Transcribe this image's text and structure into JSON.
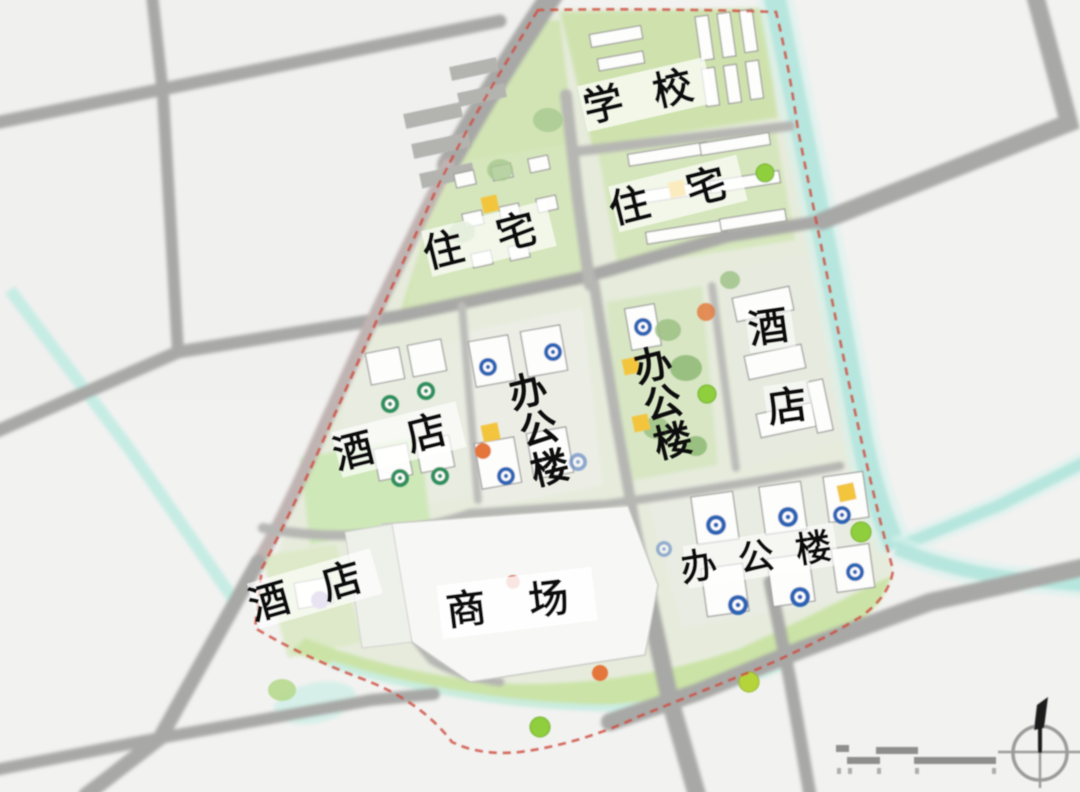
{
  "map": {
    "type": "urban-master-plan-site-map",
    "zones": [
      {
        "id": "school",
        "label": "学校",
        "display": "学 校"
      },
      {
        "id": "residential-west",
        "label": "住宅",
        "display": "住 宅"
      },
      {
        "id": "residential-east",
        "label": "住宅",
        "display": "住 宅"
      },
      {
        "id": "hotel-west",
        "label": "酒店",
        "display": "酒 店"
      },
      {
        "id": "office-central-west",
        "label": "办公楼",
        "chars": [
          "办",
          "公",
          "楼"
        ]
      },
      {
        "id": "office-central-east",
        "label": "办公楼",
        "chars": [
          "办",
          "公",
          "楼"
        ]
      },
      {
        "id": "hotel-east",
        "label": "酒店",
        "chars": [
          "酒",
          "店"
        ]
      },
      {
        "id": "hotel-southwest",
        "label": "酒店",
        "display": "酒 店"
      },
      {
        "id": "office-southeast",
        "label": "办公楼",
        "display": "办 公 楼"
      },
      {
        "id": "mall",
        "label": "商场",
        "display": "商 场"
      }
    ],
    "annotations": {
      "compass": "north-arrow",
      "scale_bar": "graphic-scale"
    },
    "palette": {
      "background": "#f1f1f0",
      "road": "#a8a8a6",
      "road_minor": "#b6b6b3",
      "boundary_road": "#c0b5b2",
      "water": "#b7e6de",
      "green_block": "#d6e6bc",
      "green_park": "#cbe3a6",
      "tree_bright": "#8fce3d",
      "building_fill": "#fdfdfb",
      "building_stroke": "#9a9a98",
      "boundary_red": "#cf4f42",
      "badge_blue": "#2a63b5",
      "badge_green": "#2f8f5b",
      "badge_yellow": "#f2c53d",
      "badge_orange": "#e4753a",
      "badge_purple": "#b9a8d6",
      "label_text": "#111111"
    }
  }
}
